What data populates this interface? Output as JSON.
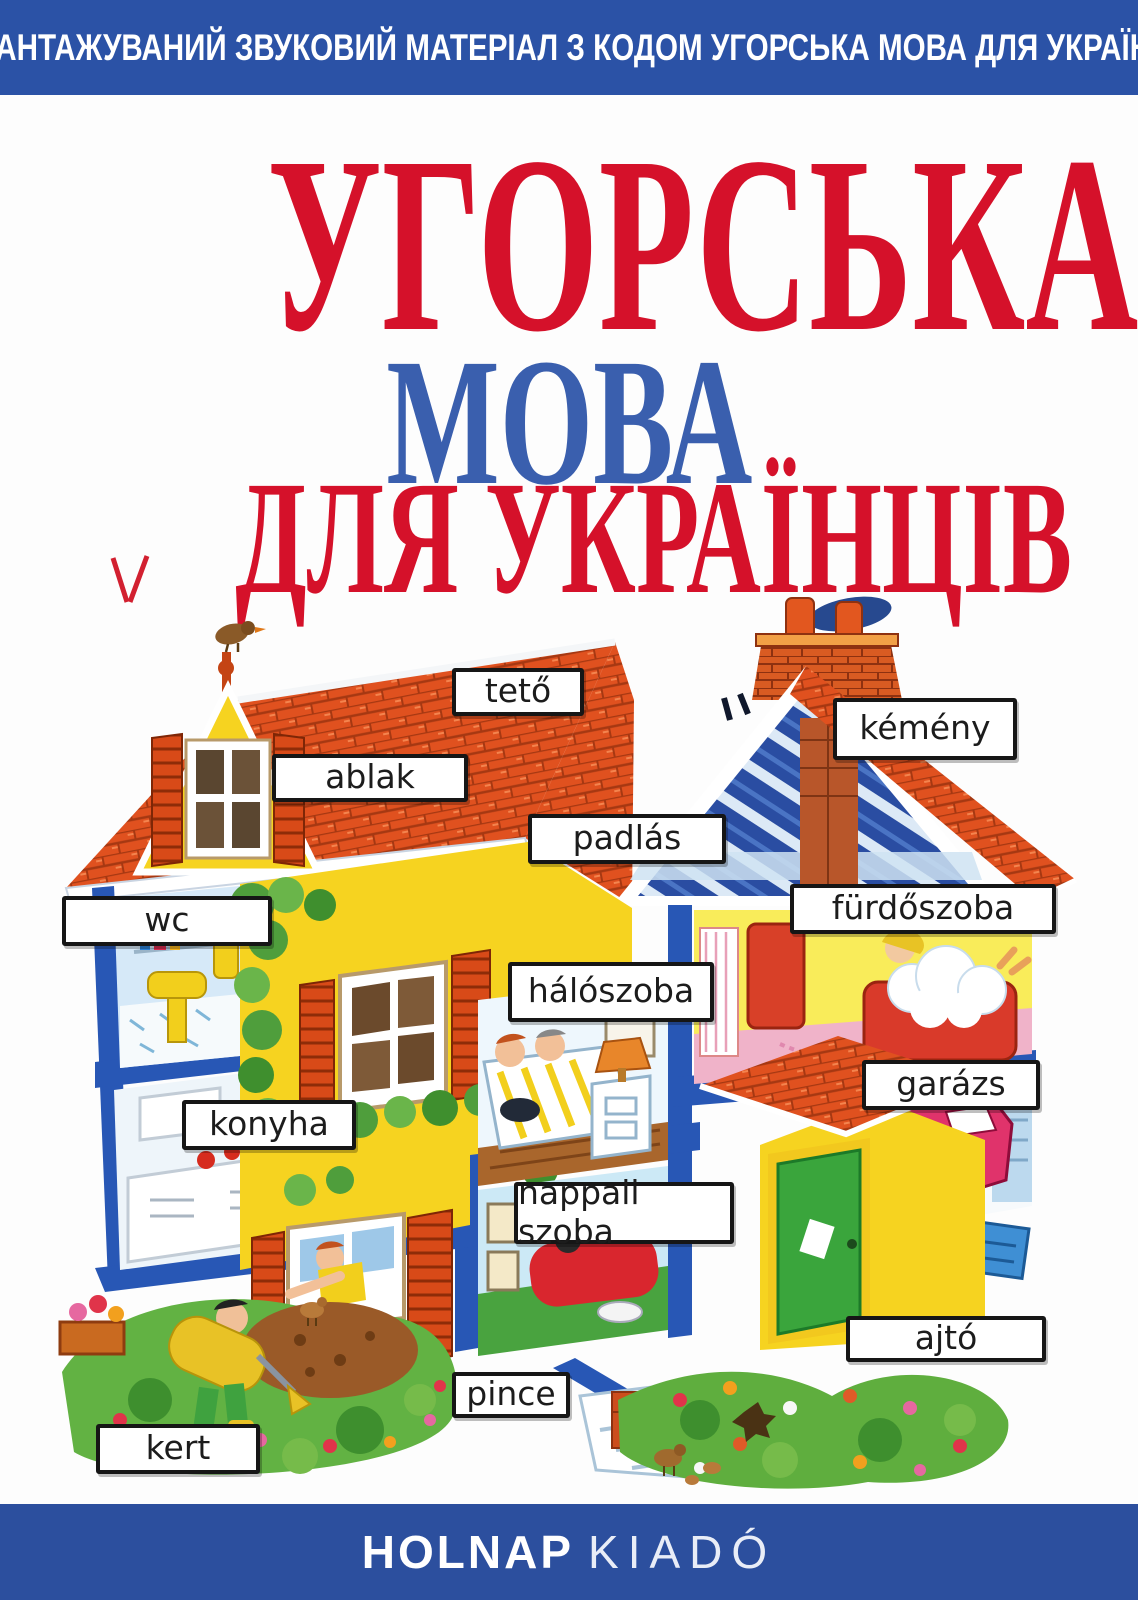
{
  "cover": {
    "top_banner": {
      "text": "ЗАВАНТАЖУВАНИЙ ЗВУКОВИЙ МАТЕРІАЛ З КОДОМ УГОРСЬКА МОВА ДЛЯ УКРАЇНЦІВ"
    },
    "title": {
      "line1": "УГОРСЬКА",
      "line2": "МОВА",
      "line3": "ДЛЯ УКРАЇНЦІВ"
    },
    "publisher": {
      "name_bold": "HOLNAP",
      "name_light": "KIADÓ"
    },
    "colors": {
      "banner_blue": "#2b52a6",
      "bottom_bar_blue": "#2c4f9e",
      "title_red": "#d5112a",
      "title_blue": "#3a5fae",
      "label_border_black": "#161616",
      "roof_red": "#e0511f",
      "wall_yellow": "#f6d320",
      "frame_blue": "#2857b5",
      "grass_green": "#5fae3e",
      "bathroom_pink": "#f0b3c9"
    }
  },
  "illustration": {
    "description": "cutaway-house-with-hungarian-room-labels",
    "labels": [
      {
        "text": "tető"
      },
      {
        "text": "kémény"
      },
      {
        "text": "ablak"
      },
      {
        "text": "padlás"
      },
      {
        "text": "wc"
      },
      {
        "text": "fürdőszoba"
      },
      {
        "text": "hálószoba"
      },
      {
        "text": "garázs"
      },
      {
        "text": "konyha"
      },
      {
        "text": "nappali szoba"
      },
      {
        "text": "ajtó"
      },
      {
        "text": "pince"
      },
      {
        "text": "kert"
      }
    ]
  }
}
